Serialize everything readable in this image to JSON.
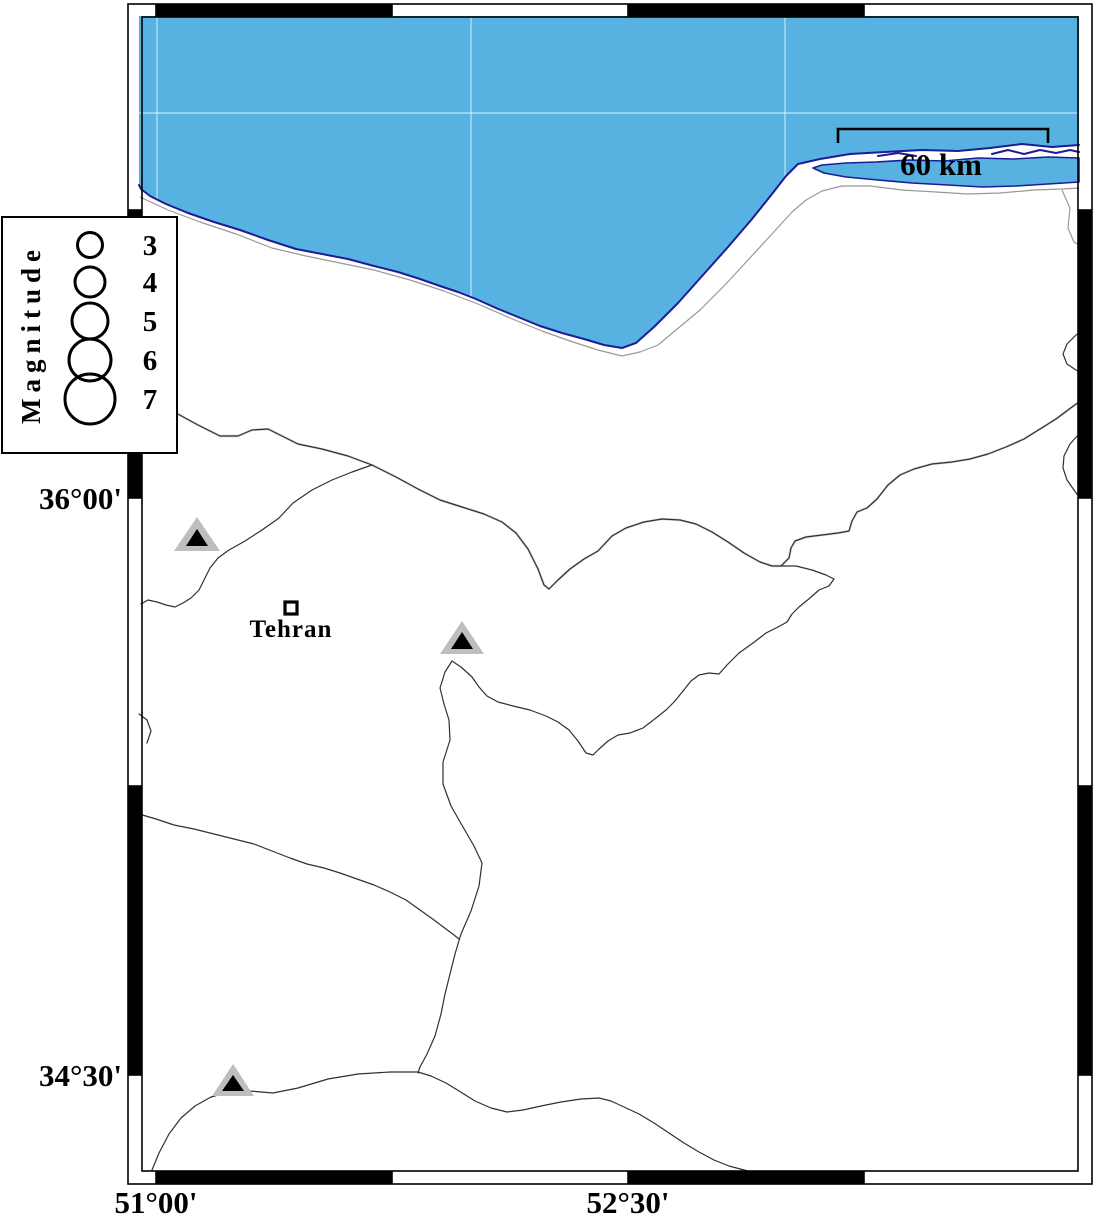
{
  "map": {
    "type": "geographic-map",
    "region_hint": "South Caspian / Tehran area shown in pixels only",
    "sea_present": true
  },
  "legend": {
    "title": "Magnitude",
    "entries": [
      {
        "label": "3",
        "radius_px": 12.5
      },
      {
        "label": "4",
        "radius_px": 15
      },
      {
        "label": "5",
        "radius_px": 18
      },
      {
        "label": "6",
        "radius_px": 21
      },
      {
        "label": "7",
        "radius_px": 25
      }
    ]
  },
  "scale_bar": {
    "label": "60 km"
  },
  "axes": {
    "left": [
      {
        "label": "36°00'",
        "y_px": 498
      },
      {
        "label": "34°30'",
        "y_px": 1075
      }
    ],
    "bottom": [
      {
        "label": "51°00'",
        "x_px": 156
      },
      {
        "label": "52°30'",
        "x_px": 628
      }
    ]
  },
  "places": [
    {
      "name": "Tehran",
      "marker": "open-square",
      "x_px": 290,
      "y_px": 608
    }
  ],
  "volcano_markers": [
    {
      "x_px": 197,
      "y_px": 537
    },
    {
      "x_px": 462,
      "y_px": 639
    },
    {
      "x_px": 233,
      "y_px": 1082
    }
  ],
  "colors": {
    "sea": "#57B2E1",
    "coastline": "#1C1C96",
    "land": "#FFFFFF",
    "boundary": "#303030",
    "boundary_halo": "#B4B4B4",
    "road": "#999999",
    "volcano_fill": "#BEBEBE",
    "frame": "#000000",
    "gridline": "rgba(255,255,255,0.55)"
  }
}
